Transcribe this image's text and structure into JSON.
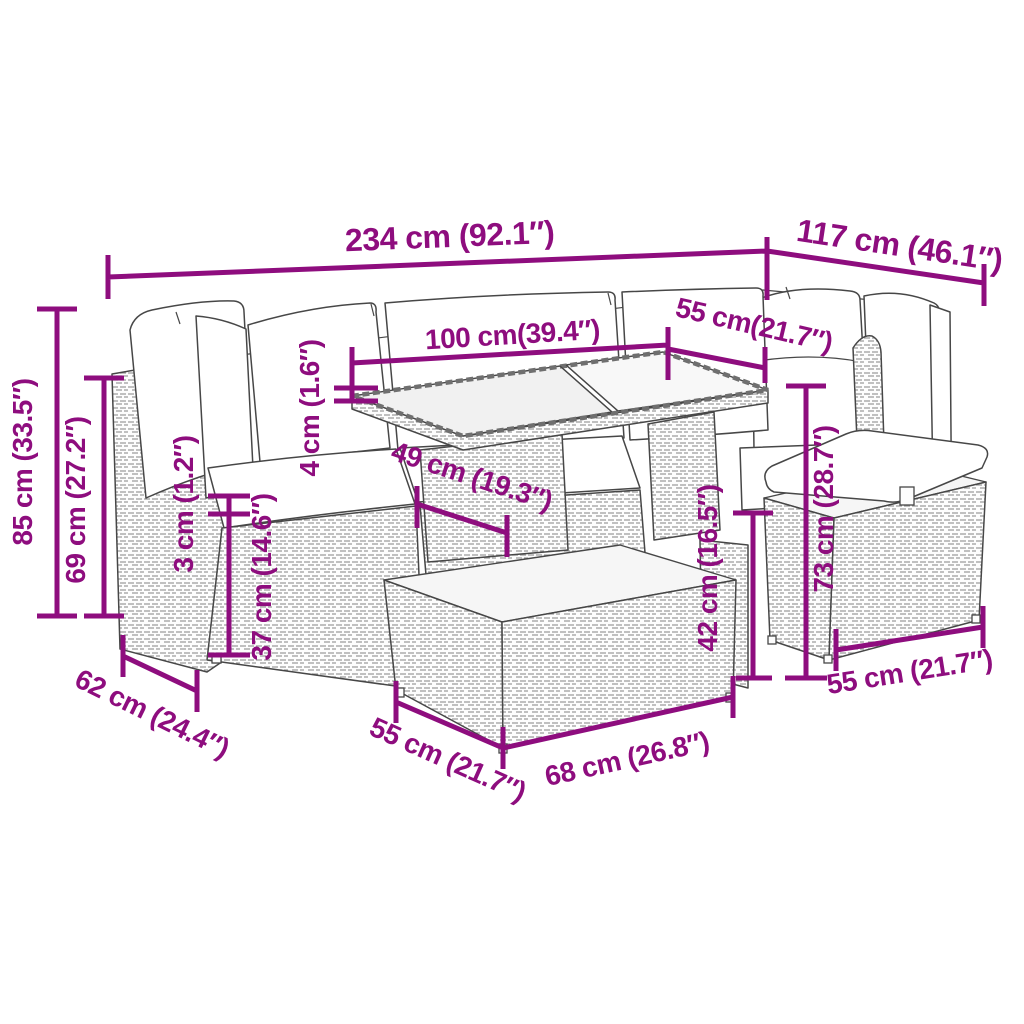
{
  "diagram": {
    "accent_color": "#8e0d7e",
    "line_color": "#474747",
    "dims": {
      "overall_width": "234 cm (92.1″)",
      "right_width": "117 cm (46.1″)",
      "table_length": "100 cm(39.4″)",
      "table_width": "55 cm(21.7″)",
      "total_height": "85 cm (33.5″)",
      "back_height": "69 cm (27.2″)",
      "top_thickness": "4 cm (1.6″)",
      "cushion_thickness": "3 cm (1.2″)",
      "seat_height": "37 cm (14.6″)",
      "table_inner_height": "49 cm (19.3″)",
      "table_lower_height": "42 cm (16.5″)",
      "table_height": "73 cm (28.7″)",
      "seat_depth": "62 cm (24.4″)",
      "module_width": "55 cm (21.7″)",
      "table_box_length": "68 cm (26.8″)",
      "stool_width": "55 cm (21.7″)"
    }
  }
}
